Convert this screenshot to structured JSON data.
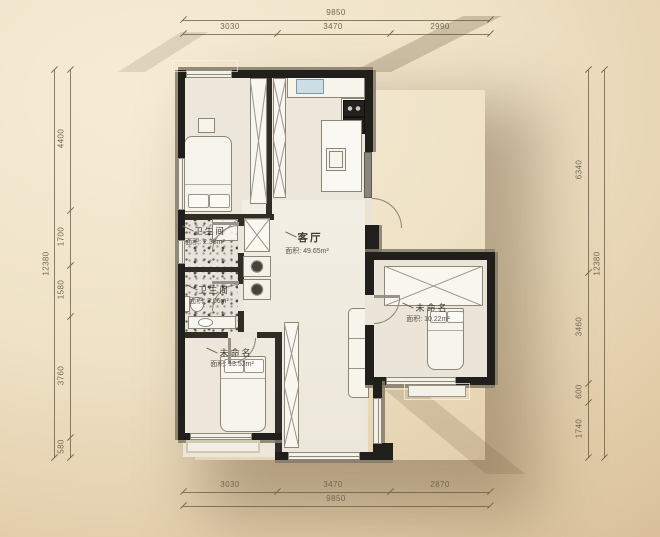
{
  "page": {
    "type": "residential-floor-plan"
  },
  "colors": {
    "background_light": "#f6ecd6",
    "background_dark": "#d3b892",
    "wall": "#211f1b",
    "wall_offset": "#97917f",
    "floor": "#ece7da",
    "bath_floor_speckle": "#e8e4db",
    "dimension_text": "#6f6853",
    "label_text": "#3e3a32",
    "sink_fill": "#ccdde6"
  },
  "rooms": [
    {
      "id": "living-room",
      "name": "客厅",
      "area": "面积: 49.65m²"
    },
    {
      "id": "bathroom-upper",
      "name": "卫生间",
      "area": "面积: 2.38m²"
    },
    {
      "id": "bathroom-lower",
      "name": "卫生间",
      "area": "面积: 3.06m²"
    },
    {
      "id": "bedroom-bottom-left",
      "name": "未命名",
      "area": "面积: 13.52m²"
    },
    {
      "id": "bedroom-right",
      "name": "未命名",
      "area": "面积: 10.22m²"
    }
  ],
  "dimensions": {
    "top": {
      "total": "9850",
      "segments": [
        "3030",
        "3470",
        "2990"
      ]
    },
    "bottom": {
      "total": "9850",
      "segments": [
        "3030",
        "3470",
        "2870"
      ]
    },
    "left": {
      "total": "12380",
      "segments": [
        "4400",
        "1700",
        "1580",
        "3760",
        "580"
      ]
    },
    "right": {
      "total": "12380",
      "segments": [
        "6340",
        "3460",
        "600",
        "1740"
      ]
    }
  }
}
